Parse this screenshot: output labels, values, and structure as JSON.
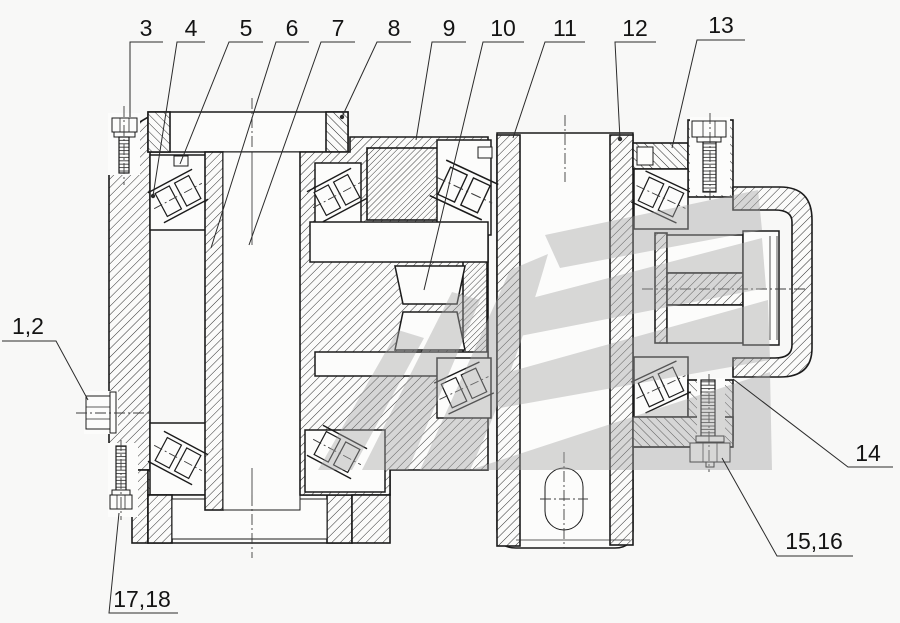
{
  "figure": {
    "background": "#f8f8f7",
    "line_color": "#1b1b1b",
    "watermark_color": "#a5a5a5"
  },
  "callouts": [
    {
      "id": "3",
      "text": "3"
    },
    {
      "id": "4",
      "text": "4"
    },
    {
      "id": "5",
      "text": "5"
    },
    {
      "id": "6",
      "text": "6"
    },
    {
      "id": "7",
      "text": "7"
    },
    {
      "id": "8",
      "text": "8"
    },
    {
      "id": "9",
      "text": "9"
    },
    {
      "id": "10",
      "text": "10"
    },
    {
      "id": "11",
      "text": "11"
    },
    {
      "id": "12",
      "text": "12"
    },
    {
      "id": "13",
      "text": "13"
    },
    {
      "id": "1_2",
      "text": "1,2"
    },
    {
      "id": "14",
      "text": "14"
    },
    {
      "id": "15_16",
      "text": "15,16"
    },
    {
      "id": "17_18",
      "text": "17,18"
    }
  ]
}
